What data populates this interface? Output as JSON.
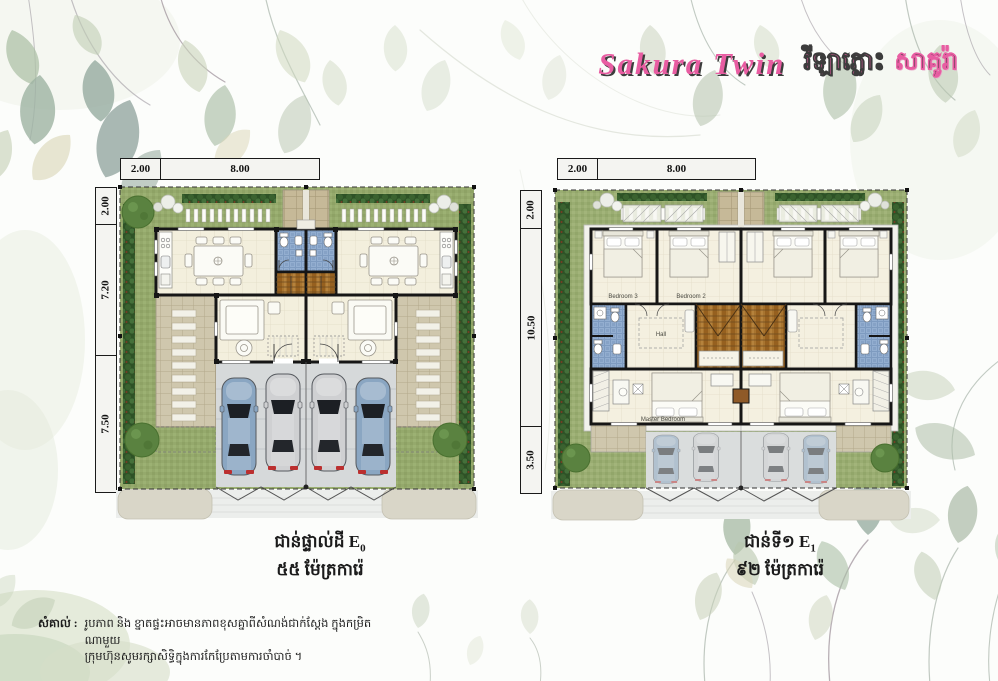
{
  "brand": {
    "script": "Sakura Twin",
    "khmer_pink": "វីឡាភ្លោះ",
    "khmer_dark": "សាគូរ៉ា"
  },
  "plans": {
    "ground": {
      "top_dims": [
        "2.00",
        "8.00"
      ],
      "side_dims": [
        "2.00",
        "7.20",
        "7.50"
      ],
      "caption_title": "ជាន់ផ្ទាល់ដី E",
      "caption_sub": "0",
      "caption_area": "៥៥ ម៉ែត្រការ៉េ"
    },
    "first": {
      "top_dims": [
        "2.00",
        "8.00"
      ],
      "side_dims": [
        "2.00",
        "10.50",
        "3.50"
      ],
      "caption_title": "ជាន់ទី១ E",
      "caption_sub": "1",
      "caption_area": "៩២ ម៉ែត្រការ៉េ",
      "rooms": {
        "bedroom3": "Bedroom 3",
        "bedroom2": "Bedroom 2",
        "hall": "Hall",
        "master": "Master Bedroom"
      }
    }
  },
  "note": {
    "label": "សំគាល់ :",
    "line1": "រូបភាព និង ខ្នាតផ្ទះអាចមានភាពខុសគ្នាពីសំណង់ជាក់ស្តែង ក្នុងកម្រិតណាមួយ",
    "line2": "ក្រុមហ៊ុនសូមរក្សាសិទ្ធិក្នុងការកែប្រែតាមការចាំបាច់ ។"
  },
  "colors": {
    "brand_pink": "#e85da2",
    "grass": "#95a96c",
    "hedge": "#3a622f",
    "bath_blue": "#7e9bc0",
    "wood": "#a8742f",
    "floor": "#f3efdd",
    "car_blue": "#8aa6c2",
    "car_silver": "#cfd0d2"
  }
}
